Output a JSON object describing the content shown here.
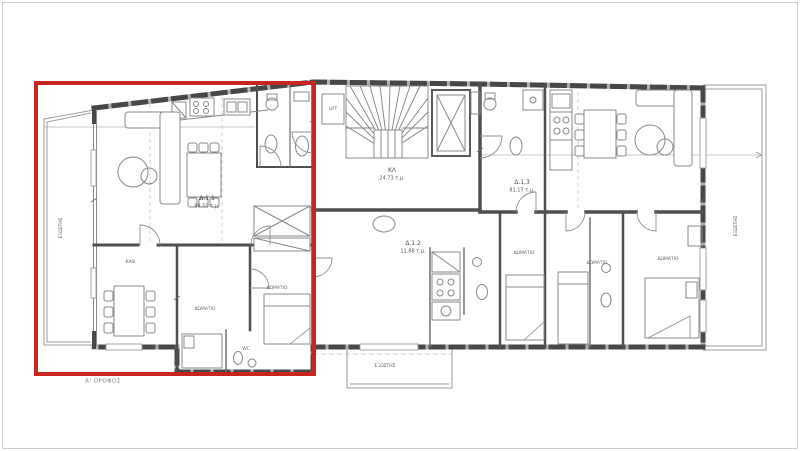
{
  "floor_label": "Α' ΟΡΟΦΟΣ",
  "units": {
    "d11": {
      "code": "Δ.1.1",
      "area": "86.50 τ.μ."
    },
    "d12": {
      "code": "Δ.1.2",
      "area": "11.88 τ.μ."
    },
    "d13": {
      "code": "Δ.1.3",
      "area": "81.17 τ.μ."
    },
    "stair": {
      "code": "ΚΛ",
      "area": "24.73 τ.μ."
    }
  },
  "labels": {
    "lift": "LIFT",
    "living": "ΚΑΘ.",
    "bedroom": "ΔΩΜΑΤΙΟ",
    "wc": "WC",
    "balcony": "ΕΞΩΣΤΗΣ"
  },
  "colors": {
    "highlight": "#c9251f",
    "exterior_wall": "#474747",
    "wall_fill": "#b0b0b0",
    "interior_wall": "#4f4f4f",
    "furniture_line": "#888888"
  }
}
